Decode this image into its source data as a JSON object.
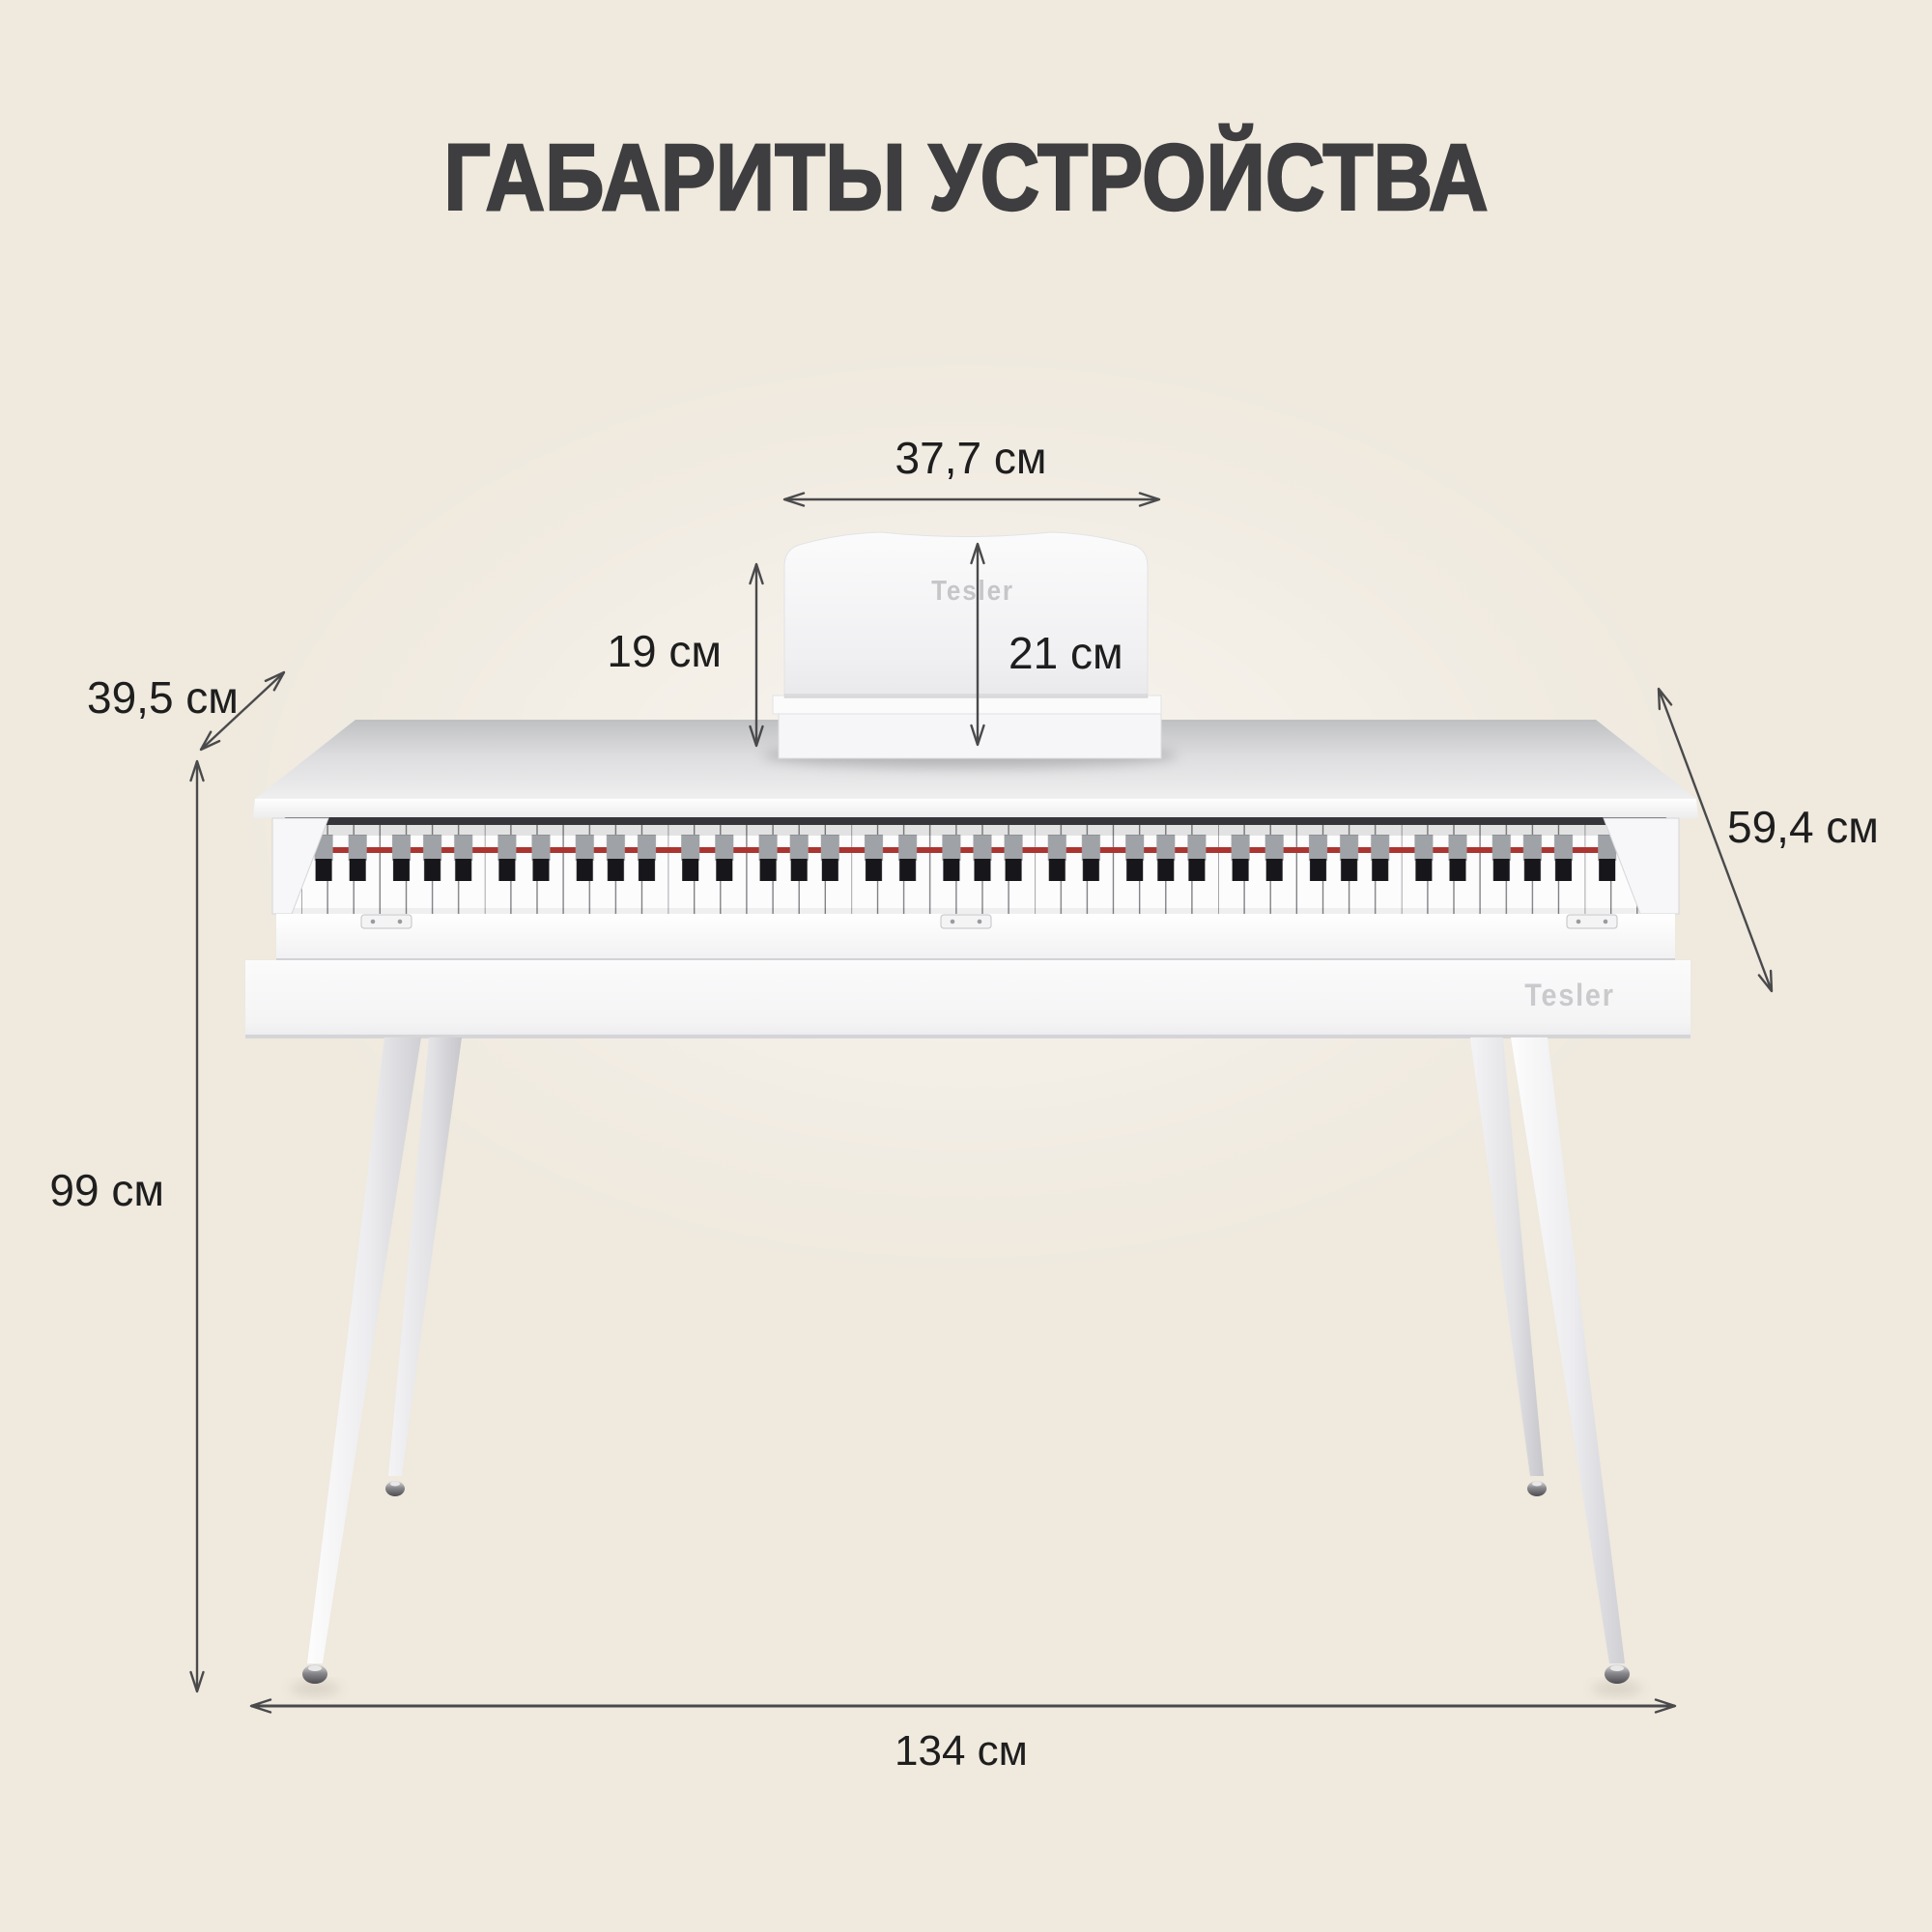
{
  "title": "ГАБАРИТЫ УСТРОЙСТВА",
  "brand": {
    "stand_logo": "Tesler",
    "body_logo": "Tesler"
  },
  "dimensions": {
    "stand_width": "37,7 см",
    "stand_height_left": "19 см",
    "stand_height_right": "21 см",
    "depth": "39,5 см",
    "side_height": "59,4 см",
    "height": "99 см",
    "width": "134 см"
  },
  "colors": {
    "background_top": "#f1ece4",
    "background_bottom": "#e6dcca",
    "title_text": "#3e3e40",
    "dimension_text": "#1e1e1e",
    "arrow": "#4a4a4c",
    "piano_white": "#fafafb",
    "piano_top_back": "#c2c3c5",
    "piano_top_front": "#f0f0f1",
    "key_slot": "#36363a",
    "felt_red": "#ab3531",
    "black_key": "#17171b",
    "black_key_top": "#9fa2a6",
    "logo_gray": "#c6c6c8",
    "metal_foot": "#55555a"
  }
}
